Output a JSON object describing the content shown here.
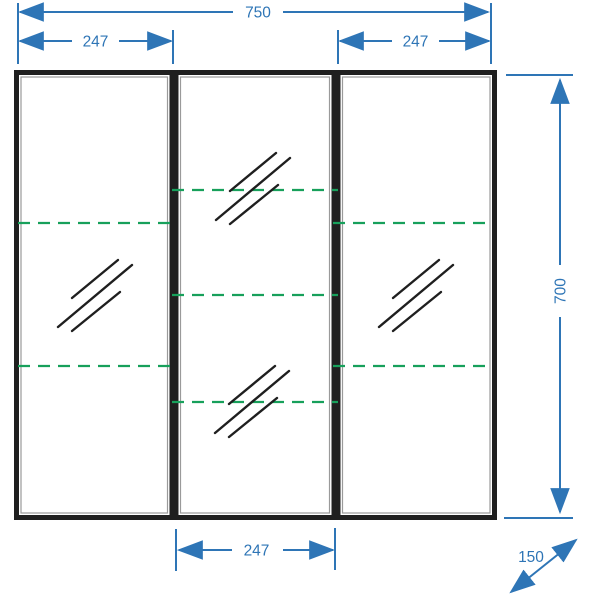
{
  "page": {
    "background": "#ffffff",
    "description": "Technical front-elevation dimension drawing of a three-door mirrored cabinet with dashed shelf lines and a depth arrow"
  },
  "colors": {
    "dimension_blue": "#2e75b6",
    "shelf_green": "#17a05b",
    "frame_black": "#1f1f1f",
    "door_outline_gray": "#9a9a9a"
  },
  "icons": {
    "mirror_glass_icon": "three parallel diagonal hatch strokes (glass/mirror symbol)"
  },
  "dimensions": {
    "total_width": {
      "value": "750",
      "placement": "top, full width"
    },
    "left_door_width": {
      "value": "247",
      "placement": "top left"
    },
    "right_door_width": {
      "value": "247",
      "placement": "top right"
    },
    "middle_door_width": {
      "value": "247",
      "placement": "bottom center"
    },
    "height": {
      "value": "700",
      "placement": "right side, vertical"
    },
    "depth": {
      "value": "150",
      "placement": "bottom right, diagonal"
    }
  },
  "cabinet": {
    "doors": [
      {
        "name": "left",
        "shelf_lines": 2,
        "mirror_marks": 1
      },
      {
        "name": "middle",
        "shelf_lines": 3,
        "mirror_marks": 2
      },
      {
        "name": "right",
        "shelf_lines": 2,
        "mirror_marks": 1
      }
    ]
  }
}
